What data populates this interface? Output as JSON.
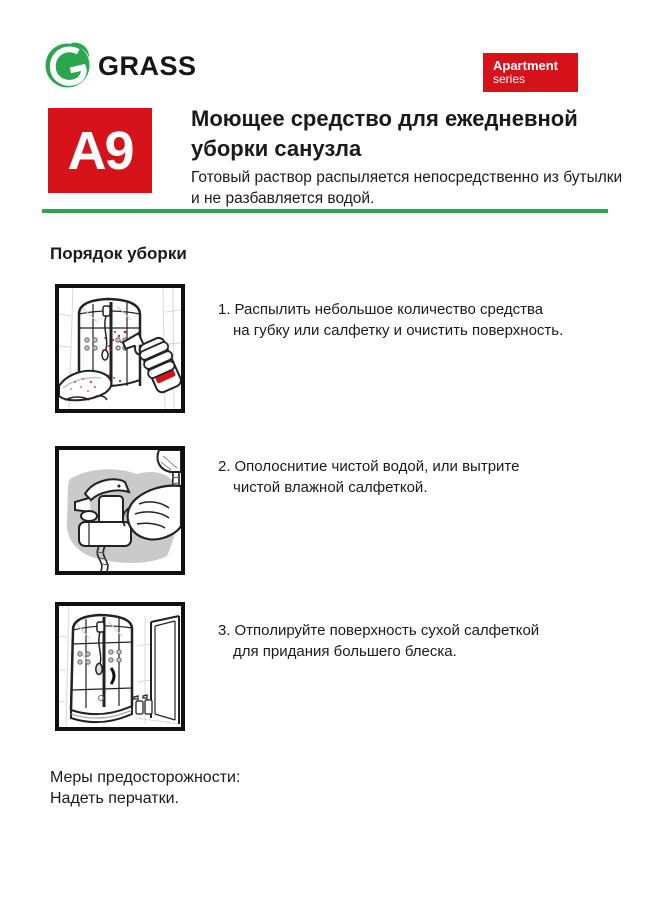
{
  "colors": {
    "brand_green": "#2aa64e",
    "accent_red": "#d6121b",
    "text": "#1a1a1a"
  },
  "brand": {
    "logo_text": "GRASS"
  },
  "series_badge": {
    "line1": "Apartment",
    "line2": "series"
  },
  "header": {
    "code": "A9",
    "title_line1": "Моющее средство для ежедневной",
    "title_line2": "уборки санузла",
    "subtitle_line1": "Готовый раствор распыляется непосредственно из бутылки",
    "subtitle_line2": "и не разбавляется водой."
  },
  "section": {
    "heading": "Порядок уборки"
  },
  "steps": [
    {
      "num": "1.",
      "line1": "Распылить небольшое количество средства",
      "line2": "на губку или салфетку и очистить поверхность.",
      "illustration": "spraying-cleaner-on-cloth-near-shower-cabin"
    },
    {
      "num": "2.",
      "line1": "Ополоснитие чистой водой, или вытрите",
      "line2": "чистой влажной салфеткой.",
      "illustration": "hand-wiping-bath-faucet"
    },
    {
      "num": "3.",
      "line1": "Отполируйте поверхность сухой салфеткой",
      "line2": "для придания большего блеска.",
      "illustration": "polished-shower-cabin-with-door"
    }
  ],
  "precautions": {
    "line1": "Меры предосторожности:",
    "line2": "Надеть перчатки."
  }
}
